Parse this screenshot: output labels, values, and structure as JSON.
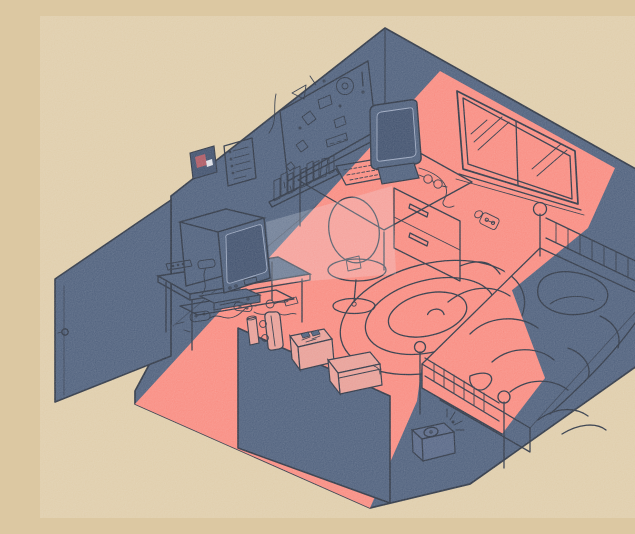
{
  "scene": {
    "type": "isometric-cutaway-illustration",
    "description": "Flat-color isometric cutaway illustration of a dim bedroom. A wide diagonal swath of warm salmon light from a two-pane window cuts across the navy room, falling over the desk, floor, low cut wall and half of the bed. Furnishings: an open door, a corkboard covered in doodles, a photo print and a list poster on the wall, a shelf of books, a desk with a CRT computer monitor, keyboard and glasses, a swivel chair, a spiral rug, a bed with spindle headboard and footboard, pillow and rumpled blanket, a CRT television on a stand with a game console below it casting a pale beam, scattered controllers and cables, and a skateboard, poster tube, box of cassette tapes and a shoebox resting on the cut wall ledge, with a small ringing alarm box on the floor.",
    "objects": [
      "open-door",
      "corkboard",
      "photo-print",
      "list-poster",
      "book-shelf",
      "window",
      "power-outlet",
      "desk",
      "drawer-unit",
      "crt-monitor",
      "keyboard",
      "glasses",
      "swivel-chair",
      "spiral-rug",
      "bed",
      "pillow",
      "blanket",
      "tv-stand",
      "crt-tv",
      "game-console",
      "remote-control",
      "game-controllers",
      "cables",
      "skateboard",
      "poster-tube",
      "tape-box",
      "shoebox",
      "alarm-box",
      "light-swath",
      "tv-beam"
    ],
    "lighting": "single warm light band entering from window, upper-right to lower-left"
  },
  "palette": {
    "canvas": "#dcc8a2",
    "navy": "#3e5170",
    "navy-soft": "#48597b",
    "navy-deep": "#2f4160",
    "salmon": "#f88175",
    "salmon-muted": "#e6968d",
    "ink": "#1b2434",
    "rim": "#93a0ba",
    "poster-red": "#a64a55",
    "paper": "#d9dce3",
    "beam": "rgba(233,238,245,0.22)"
  }
}
